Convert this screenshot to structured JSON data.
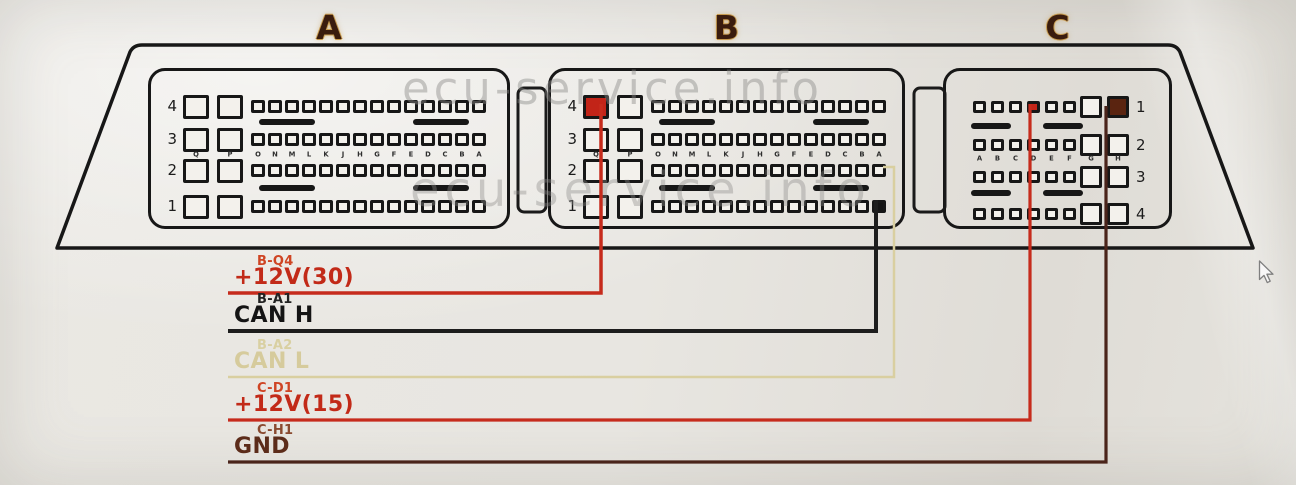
{
  "watermark": {
    "text": "ecu-service.info"
  },
  "connectors": [
    {
      "id": "A",
      "header": "A",
      "number_side": "left",
      "row_numbers": [
        "4",
        "3",
        "2",
        "1"
      ],
      "large_pin_letters": [
        "Q",
        "P"
      ],
      "small_pin_letters": [
        "O",
        "N",
        "M",
        "L",
        "K",
        "J",
        "H",
        "G",
        "F",
        "E",
        "D",
        "C",
        "B",
        "A"
      ],
      "highlighted_pins": []
    },
    {
      "id": "B",
      "header": "B",
      "number_side": "left",
      "row_numbers": [
        "4",
        "3",
        "2",
        "1"
      ],
      "large_pin_letters": [
        "Q",
        "P"
      ],
      "small_pin_letters": [
        "O",
        "N",
        "M",
        "L",
        "K",
        "J",
        "H",
        "G",
        "F",
        "E",
        "D",
        "C",
        "B",
        "A"
      ],
      "highlighted_pins": [
        {
          "row": "4",
          "pin": "Q",
          "fill": "#c22418"
        },
        {
          "row": "1",
          "pin": "A",
          "fill": "#141414"
        }
      ]
    },
    {
      "id": "C",
      "header": "C",
      "number_side": "right",
      "row_numbers": [
        "1",
        "2",
        "3",
        "4"
      ],
      "small_pin_letters": [
        "A",
        "B",
        "C",
        "D",
        "E",
        "F"
      ],
      "large_pin_letters": [
        "G",
        "H"
      ],
      "highlighted_pins": [
        {
          "row": "1",
          "pin": "D",
          "fill": "#c22418"
        },
        {
          "row": "1",
          "pin": "H",
          "fill": "#5a2410"
        }
      ]
    }
  ],
  "wires": [
    {
      "code": "B-Q4",
      "label": "+12V(30)",
      "code_color": "#cf4423",
      "label_color": "#c22a18",
      "wire_color": "#c62b1c",
      "width": 3.5,
      "path": [
        [
          601,
          104
        ],
        [
          601,
          293
        ],
        [
          228,
          293
        ]
      ]
    },
    {
      "code": "B-A1",
      "label": "CAN H",
      "code_color": "#222222",
      "label_color": "#141414",
      "wire_color": "#1d1d1d",
      "width": 4,
      "path": [
        [
          876,
          200
        ],
        [
          876,
          331
        ],
        [
          228,
          331
        ]
      ]
    },
    {
      "code": "B-A2",
      "label": "CAN L",
      "code_color": "#d9d0a2",
      "label_color": "#d6cb9c",
      "wire_color": "#d9cfa0",
      "width": 2.5,
      "path": [
        [
          883,
          167
        ],
        [
          894,
          167
        ],
        [
          894,
          377
        ],
        [
          228,
          377
        ]
      ]
    },
    {
      "code": "C-D1",
      "label": "+12V(15)",
      "code_color": "#cf4423",
      "label_color": "#c22a18",
      "wire_color": "#c62b1c",
      "width": 3.2,
      "path": [
        [
          1030,
          104
        ],
        [
          1030,
          420
        ],
        [
          228,
          420
        ]
      ]
    },
    {
      "code": "C-H1",
      "label": "GND",
      "code_color": "#8a4a30",
      "label_color": "#5c2c1a",
      "wire_color": "#4a241a",
      "width": 3.2,
      "path": [
        [
          1106,
          106
        ],
        [
          1106,
          462
        ],
        [
          228,
          462
        ]
      ]
    }
  ],
  "cursor": {
    "visible": true
  }
}
